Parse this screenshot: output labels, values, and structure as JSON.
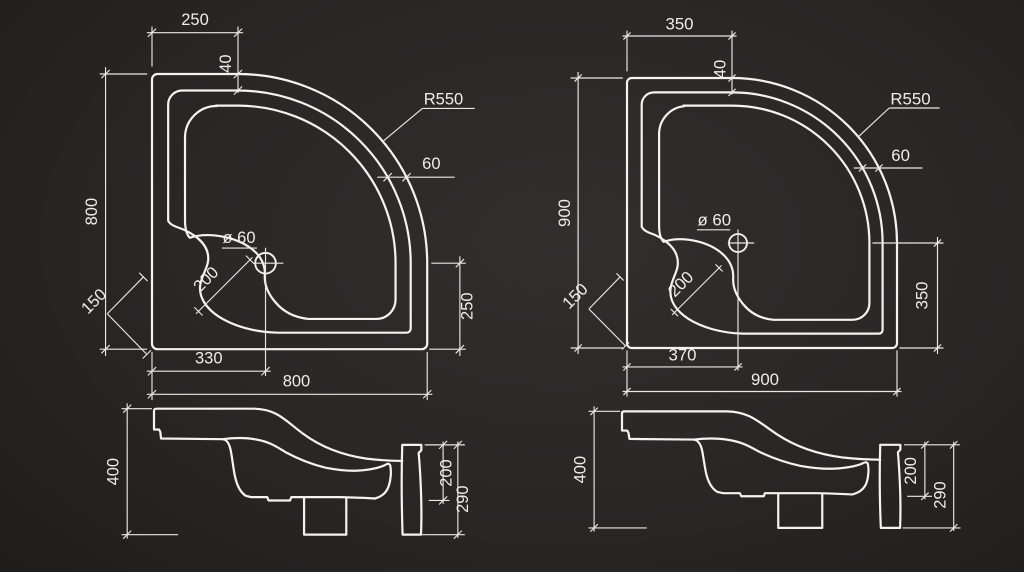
{
  "colors": {
    "background_center": "#312f2e",
    "background_edge": "#121211",
    "line": "#f3f3f2",
    "text": "#ededec"
  },
  "panels": [
    {
      "top": {
        "top_offset": "250",
        "rim_step": "40",
        "radius": "R550",
        "rim_width": "60",
        "height": "800",
        "corner_gap": "150",
        "ledge_width": "200",
        "drain": "ø 60",
        "drain_from_bottom": "250",
        "drain_from_left": "330",
        "width": "800"
      },
      "side": {
        "height": "400",
        "upper": "200",
        "lower": "290"
      }
    },
    {
      "top": {
        "top_offset": "350",
        "rim_step": "40",
        "radius": "R550",
        "rim_width": "60",
        "height": "900",
        "corner_gap": "150",
        "ledge_width": "200",
        "drain": "ø 60",
        "drain_from_bottom": "350",
        "drain_from_left": "370",
        "width": "900"
      },
      "side": {
        "height": "400",
        "upper": "200",
        "lower": "290"
      }
    }
  ]
}
